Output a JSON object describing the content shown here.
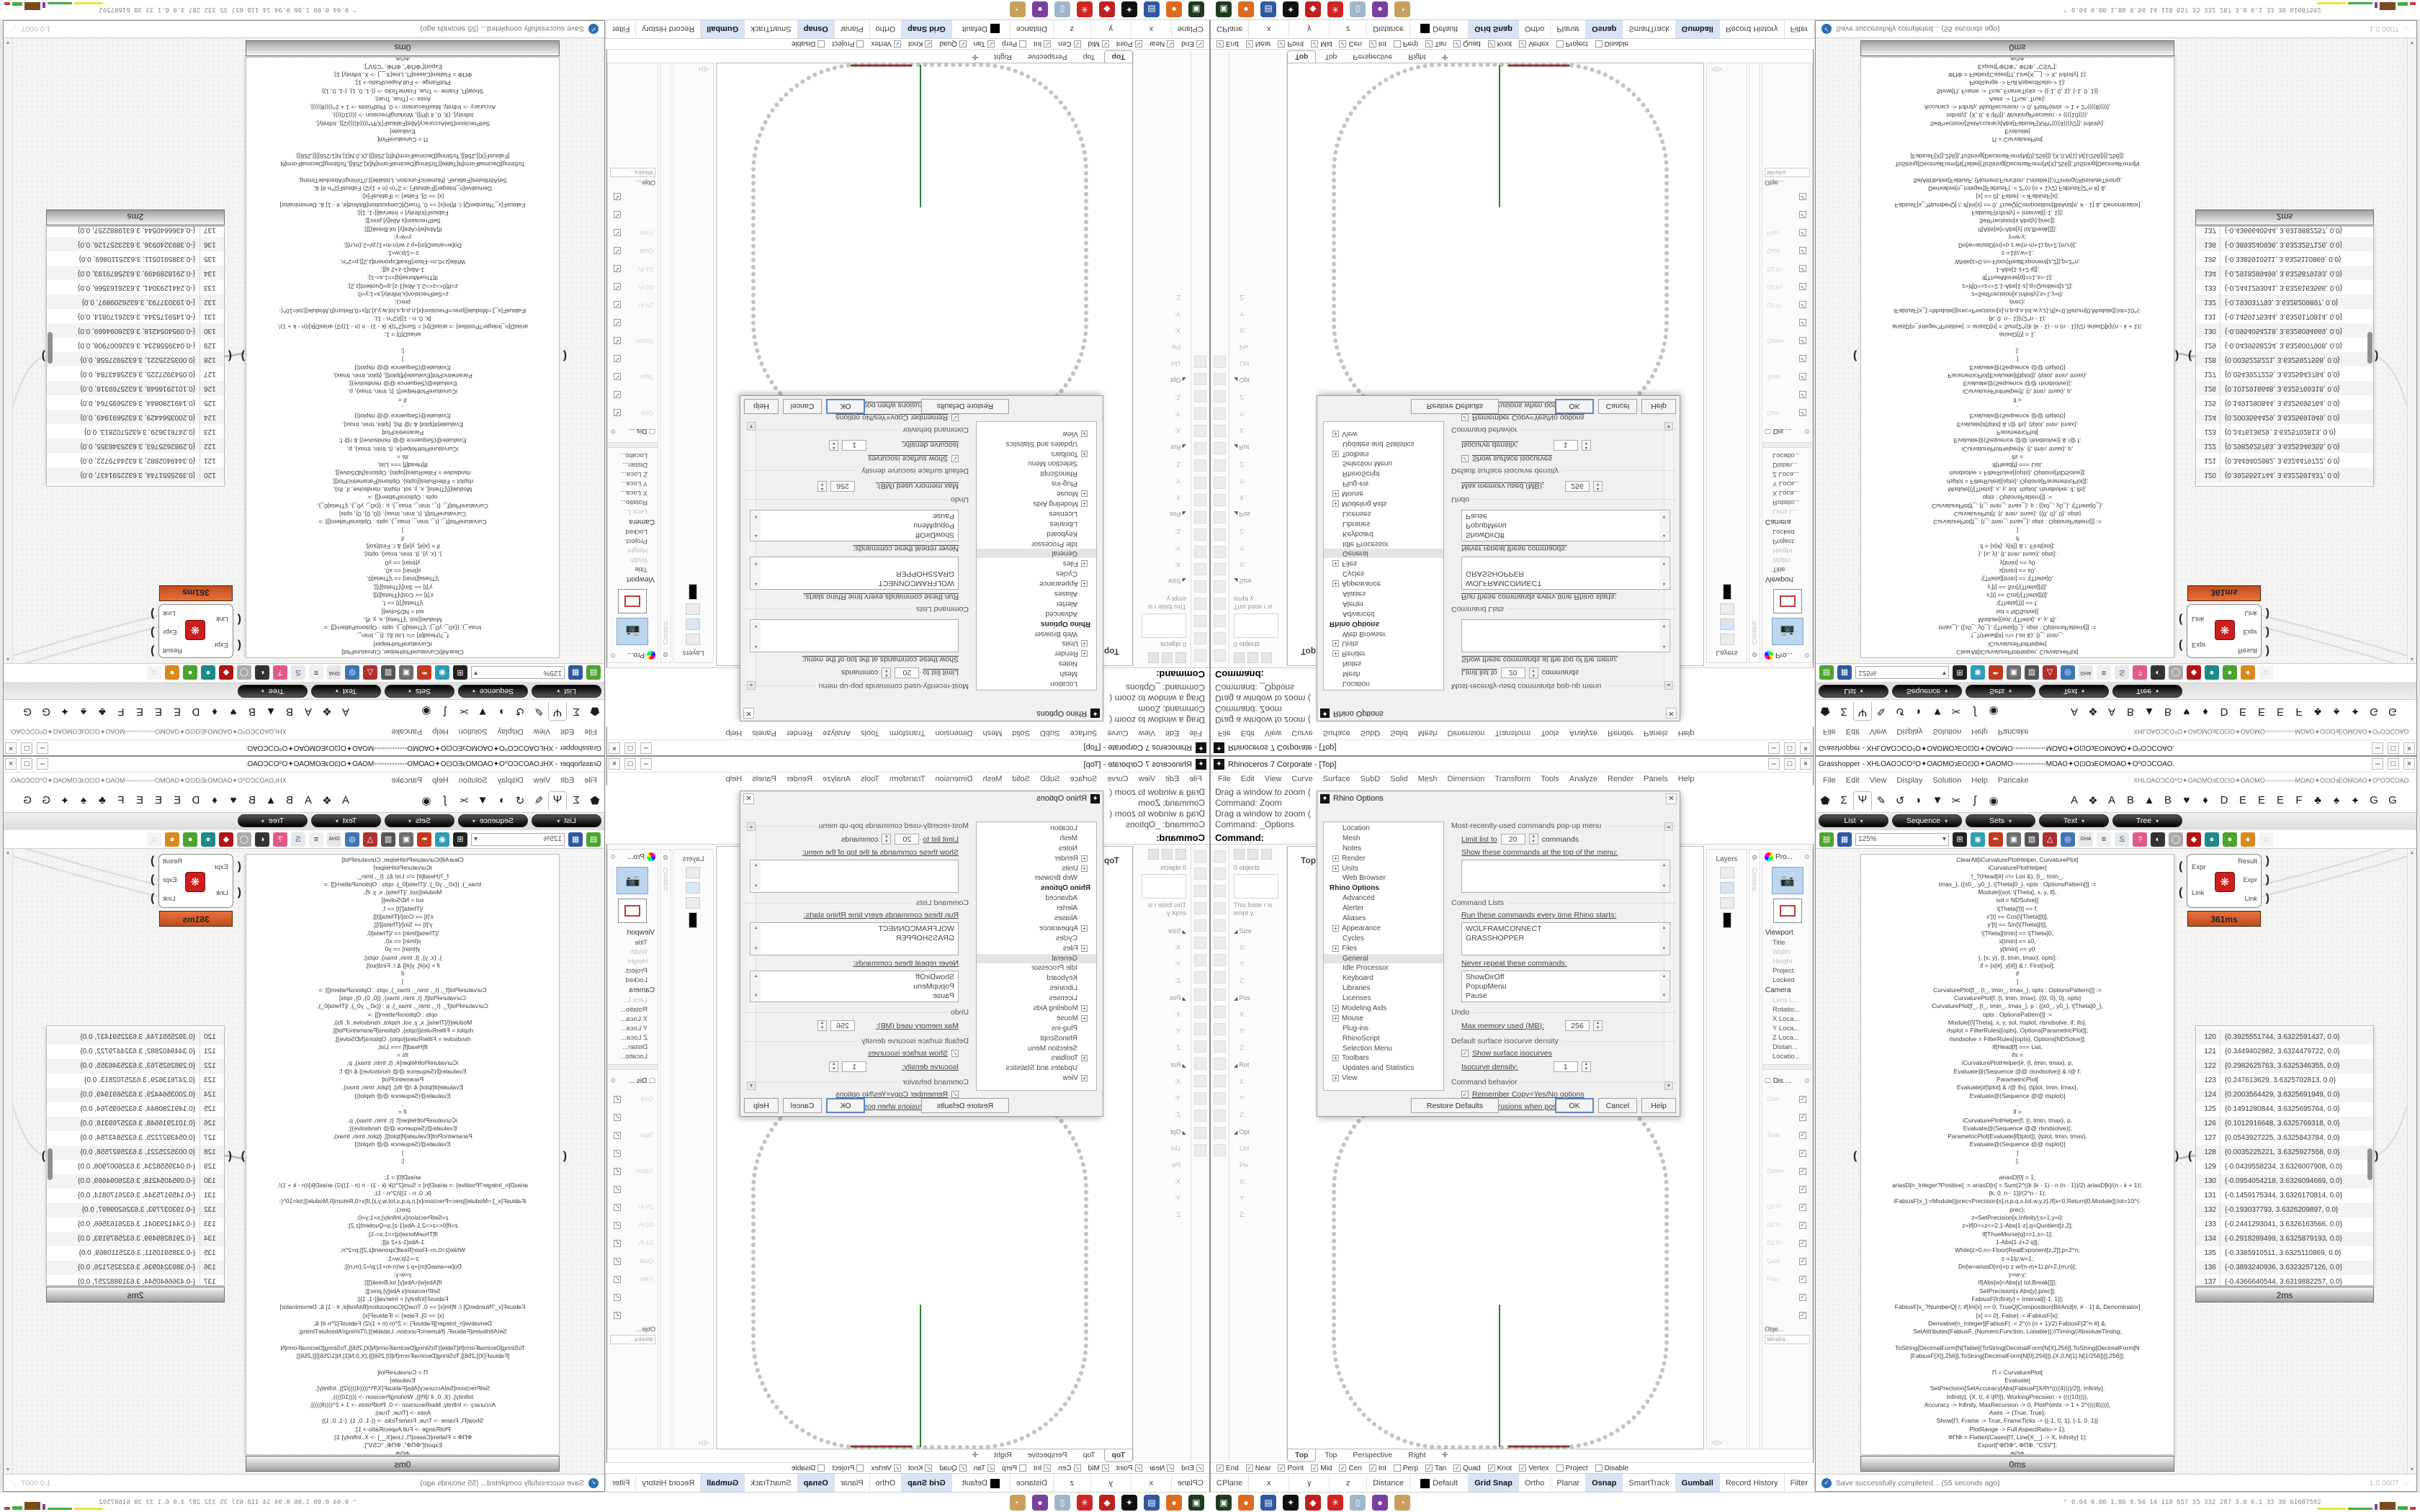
{
  "rhino": {
    "title": "Rhinoceros 7 Corporate - [Top]",
    "window_buttons": [
      "–",
      "□",
      "×"
    ],
    "menus": [
      "File",
      "Edit",
      "View",
      "Curve",
      "Surface",
      "SubD",
      "Solid",
      "Mesh",
      "Dimension",
      "Transform",
      "Tools",
      "Analyze",
      "Render",
      "Panels",
      "Help"
    ],
    "command_lines": [
      "Drag a window to zoom (",
      "Command: Zoom",
      "Drag a window to zoom (",
      "Command: _Options"
    ],
    "command_prompt": "Command:",
    "viewport": {
      "active_label": "Top",
      "tabs": [
        "Top",
        "Top",
        "Perspective",
        "Right"
      ],
      "new_tab_icon": "✛",
      "axis_green": "#2f7e2f",
      "axis_red": "#8b3434",
      "curve_color": "#c3c3c3"
    },
    "left_panel": {
      "object_count": "0 objects",
      "empty_note": "This folde r is empt y.",
      "rows": [
        {
          "t": "Size",
          "h": true
        },
        {
          "t": "X:"
        },
        {
          "t": "Y:"
        },
        {
          "t": "Z:"
        },
        {
          "t": "Pos",
          "h": true
        },
        {
          "t": "X:"
        },
        {
          "t": "Y:"
        },
        {
          "t": "Z:"
        },
        {
          "t": "Rot",
          "h": true
        },
        {
          "t": "X:"
        },
        {
          "t": "Y:"
        },
        {
          "t": "Z:"
        },
        {
          "t": "Opt",
          "h": true
        },
        {
          "t": "Uni"
        },
        {
          "t": "Piv"
        },
        {
          "t": "X:"
        },
        {
          "t": "Y:"
        },
        {
          "t": "Z:"
        }
      ]
    },
    "right_panels": {
      "layers_label": "Layers",
      "constraint_label": "Constra...",
      "properties_tab": "Pro...",
      "viewport_header": "Viewport",
      "viewport_rows": [
        {
          "t": "Title"
        },
        {
          "t": "Width",
          "dim": true
        },
        {
          "t": "Height",
          "dim": true
        },
        {
          "t": "Project."
        },
        {
          "t": "Locked"
        }
      ],
      "camera_header": "Camera",
      "camera_rows": [
        {
          "t": "Lens L...",
          "dim": true
        },
        {
          "t": "Rotatio..."
        },
        {
          "t": "X Loca..."
        },
        {
          "t": "Y Loca..."
        },
        {
          "t": "Z Loca..."
        },
        {
          "t": "Distan..."
        },
        {
          "t": "Locatio..."
        }
      ],
      "display_tab": "Dis ...",
      "display_row_labels": [
        "Cont",
        "",
        "Tapa",
        "",
        "Option",
        "",
        "UV Fl",
        "G0 Pr",
        "G1 Pr",
        "Quali",
        "Flatn",
        "",
        ""
      ],
      "object_label": "Obje...",
      "display_mode": "Wirefra..."
    },
    "osnap": [
      {
        "label": "End",
        "checked": true
      },
      {
        "label": "Near",
        "checked": true
      },
      {
        "label": "Point",
        "checked": true
      },
      {
        "label": "Mid",
        "checked": true
      },
      {
        "label": "Cen",
        "checked": true
      },
      {
        "label": "Int",
        "checked": true
      },
      {
        "label": "Perp",
        "checked": false
      },
      {
        "label": "Tan",
        "checked": true
      },
      {
        "label": "Quad",
        "checked": true
      },
      {
        "label": "Knot",
        "checked": true
      },
      {
        "label": "Vertex",
        "checked": true
      },
      {
        "label": "Project",
        "checked": false
      },
      {
        "label": "Disable",
        "checked": false
      }
    ],
    "status_bar": [
      {
        "label": "CPlane",
        "w": 60
      },
      {
        "label": "x",
        "w": 110
      },
      {
        "label": "y",
        "w": 110
      },
      {
        "label": "z",
        "w": 100
      },
      {
        "label": "Distance",
        "w": 90
      },
      {
        "label": "Default",
        "w": 170,
        "swatch": true
      },
      {
        "label": "Grid Snap",
        "active": true
      },
      {
        "label": "Ortho"
      },
      {
        "label": "Planar"
      },
      {
        "label": "Osnap",
        "active": true
      },
      {
        "label": "SmartTrack"
      },
      {
        "label": "Gumball",
        "active": true
      },
      {
        "label": "Record History"
      },
      {
        "label": "Filter"
      }
    ],
    "options_dialog": {
      "title": "Rhino Options",
      "tree": [
        {
          "label": "Location"
        },
        {
          "label": "Mesh"
        },
        {
          "label": "Notes"
        },
        {
          "label": "Render",
          "plus": true
        },
        {
          "label": "Units",
          "plus": true
        },
        {
          "label": "Web Browser"
        },
        {
          "label": "Rhino Options",
          "root": true
        },
        {
          "label": "Advanced"
        },
        {
          "label": "Alerter"
        },
        {
          "label": "Aliases"
        },
        {
          "label": "Appearance",
          "plus": true
        },
        {
          "label": "Cycles"
        },
        {
          "label": "Files",
          "plus": true
        },
        {
          "label": "General",
          "selected": true
        },
        {
          "label": "Idle Processor"
        },
        {
          "label": "Keyboard"
        },
        {
          "label": "Libraries"
        },
        {
          "label": "Licenses"
        },
        {
          "label": "Modeling Aids",
          "plus": true
        },
        {
          "label": "Mouse",
          "plus": true
        },
        {
          "label": "Plug-ins"
        },
        {
          "label": "RhinoScript"
        },
        {
          "label": "Selection Menu"
        },
        {
          "label": "Toolbars",
          "plus": true
        },
        {
          "label": "Updates and Statistics"
        },
        {
          "label": "View",
          "plus": true
        }
      ],
      "mru_header": "Most-recently-used commands pop-up menu",
      "limit_label": "Limit list to",
      "limit_value": "20",
      "limit_suffix": "commands",
      "show_label": "Show these commands at the top of the menu:",
      "cmdlists_header": "Command Lists",
      "run_label": "Run these commands every time Rhino starts:",
      "run_items": [
        "WOLFRAMCONNECT",
        "GRASSHOPPER"
      ],
      "never_label": "Never repeat these commands:",
      "never_items": [
        "ShowDirOff",
        "PopupMenu",
        "Pause"
      ],
      "undo_header": "Undo",
      "memory_label": "Max memory used (MB):",
      "memory_value": "256",
      "iso_header": "Default surface isocurve density",
      "iso_check": "Show surface isocurves",
      "density_label": "Isocurve density:",
      "density_value": "1",
      "behavior_header": "Command behavior",
      "behavior_checks": [
        "Remember Copy=Yes/No options",
        "Use extrusions when possible"
      ],
      "buttons": [
        "Restore Defaults",
        "OK",
        "Cancel",
        "Help"
      ]
    }
  },
  "gh": {
    "title": "Grasshopper - XHĿΟΑΟϽCΟ⁰Ο✦ΟΑΟΜΟ϶ΕΟ⊡Ο✦ΟΑΟΜΟ◦◦◦◦◦◦◦◦◦◦◦◦◦ΜΟΑΟ✦Ο⊡Ο϶ΕΟΜΟΑΟ✦Ο⁰ΟϽCΟΑΟ.",
    "menus": [
      "File",
      "Edit",
      "View",
      "Display",
      "Solution",
      "Help",
      "Pancake"
    ],
    "doc_glyphs": "XHĿΟΑΟϽCΟ⁰Ο✦ΟΑΟΜΟ϶ΕΟ⊡Ο✦ΟΑΟΜΟ◦◦◦◦◦◦◦◦◦◦◦◦◦ΜΟΑΟ✦Ο⊡Ο϶ΕΟΜΟΑΟ✦Ο⁰ΟϽCΟΑΟ.",
    "param_icons": [
      {
        "name": "params-geometry-icon",
        "glyph": "⬟"
      },
      {
        "name": "params-maths-icon",
        "glyph": "Σ"
      },
      {
        "name": "params-primitive-icon",
        "glyph": "Ψ",
        "active": true
      },
      {
        "name": "params-input-icon",
        "glyph": "✎"
      },
      {
        "name": "curve-icon",
        "glyph": "↺"
      },
      {
        "name": "surface-icon",
        "glyph": "◗"
      },
      {
        "name": "mesh-icon",
        "glyph": "▼"
      },
      {
        "name": "intersect-icon",
        "glyph": "✂"
      },
      {
        "name": "transform-icon",
        "glyph": "ʃ"
      },
      {
        "name": "display-icon",
        "glyph": "◉"
      }
    ],
    "plugin_icons": [
      {
        "name": "tab-a1",
        "glyph": "A"
      },
      {
        "name": "tab-skull",
        "glyph": "❖"
      },
      {
        "name": "tab-a2",
        "glyph": "A"
      },
      {
        "name": "tab-b1",
        "glyph": "B"
      },
      {
        "name": "tab-mountain",
        "glyph": "▲"
      },
      {
        "name": "tab-b2",
        "glyph": "B"
      },
      {
        "name": "tab-shield",
        "glyph": "♥"
      },
      {
        "name": "tab-bird",
        "glyph": "♦"
      },
      {
        "name": "tab-d",
        "glyph": "D"
      },
      {
        "name": "tab-e1",
        "glyph": "E"
      },
      {
        "name": "tab-e2",
        "glyph": "E"
      },
      {
        "name": "tab-e3",
        "glyph": "E"
      },
      {
        "name": "tab-f",
        "glyph": "F"
      },
      {
        "name": "tab-fly",
        "glyph": "♣"
      },
      {
        "name": "tab-paw",
        "glyph": "♠"
      },
      {
        "name": "tab-feather",
        "glyph": "✦"
      },
      {
        "name": "tab-g1",
        "glyph": "G"
      },
      {
        "name": "tab-g2",
        "glyph": "G"
      }
    ],
    "pills": [
      "List",
      "Sequence",
      "Sets",
      "Text",
      "Tree"
    ],
    "zoom_value": "125%",
    "toolbar_icons": [
      {
        "name": "new-document-icon",
        "glyph": "▤",
        "bg": "#4da32f"
      },
      {
        "name": "save-document-icon",
        "glyph": "▦",
        "bg": "#2f58a3"
      },
      {
        "name": "zoom-extents-icon",
        "glyph": "⊞",
        "bg": "#222"
      },
      {
        "name": "preview-eye-icon",
        "glyph": "◉",
        "bg": "#2d9db5"
      },
      {
        "name": "draw-pen-icon",
        "glyph": "✒",
        "bg": "#c23a1f"
      },
      {
        "name": "bake-icon",
        "glyph": "▣",
        "bg": "#6d6d6d"
      },
      {
        "name": "speaker-icon",
        "glyph": "▥",
        "bg": "#555"
      },
      {
        "name": "tripod-icon",
        "glyph": "△",
        "bg": "#b03030"
      },
      {
        "name": "core-icon",
        "glyph": "◎",
        "bg": "#3f74b5"
      },
      {
        "name": "gha-icon",
        "glyph": "GHA",
        "bg": "#e8e8e8",
        "fg": "#333"
      },
      {
        "name": "script-doc-icon",
        "glyph": "≡",
        "bg": "#f0f0f0",
        "fg": "#333"
      },
      {
        "name": "search-s-icon",
        "glyph": "S",
        "bg": "#e8e8e8",
        "fg": "#2d6db5"
      },
      {
        "name": "cluster-icon",
        "glyph": "?",
        "bg": "#e05a8a"
      },
      {
        "name": "mesh-spheres-icon",
        "glyph": "◐",
        "bg": "#333"
      },
      {
        "name": "wireframe-icon",
        "glyph": "◯",
        "bg": "#aaa"
      },
      {
        "name": "gem-icon",
        "glyph": "◆",
        "bg": "#b01515"
      },
      {
        "name": "ball-teal-icon",
        "glyph": "●",
        "bg": "#1d8a8a"
      },
      {
        "name": "ball-green-icon",
        "glyph": "●",
        "bg": "#4da32f"
      },
      {
        "name": "ball-orange-icon",
        "glyph": "●",
        "bg": "#d98a1f"
      },
      {
        "name": "selection-dashed-icon",
        "glyph": "◌",
        "bg": "#f4f4f4",
        "fg": "#777"
      }
    ],
    "expr": {
      "inputs": [
        "Expr",
        "Link"
      ],
      "outputs": [
        "Result",
        "Expr",
        "Link"
      ],
      "time": "361ms",
      "icon": "❋"
    },
    "code_time": "0ms",
    "list_time": "2ms",
    "status_left": "Save successfully completed... (55 seconds ago)",
    "status_right": "1.0.0007",
    "code_lines": [
      "ClearAll[iCurvaturePlotHelper, CurvaturePlot]",
      "iCurvaturePlotHelper[",
      "f_?(Head[#] =!= List &), {t_, tmin_,",
      "tmax_}, {{x0_, y0_}, \\[Theta]0_}, opts : OptionsPattern[]] :=",
      "Module[{sol, \\[Theta], x, y, if},",
      "sol = NDSolve[{",
      "\\[Theta]'[t] == f,",
      "x'[t] == Cos[\\[Theta][t]],",
      "y'[t] == Sin[\\[Theta][t]],",
      "\\[Theta][tmin] == \\[Theta]0,",
      "x[tmin] == x0,",
      "y[tmin] == y0",
      "}, {x, y}, {t, tmin, tmax}, opts];",
      "if = {x[#], y[#]} & /. First[sol];",
      "if",
      "]",
      "CurvaturePlot[f_, {t_, tmin_, tmax_}, opts : OptionsPattern[]] :=",
      "CurvaturePlot[f, {t, tmin, tmax}, {{0, 0}, 0}, opts]",
      "CurvaturePlot[f_, {t_, tmin_, tmax_}, p : {{x0_, y0_}, \\[Theta]0_},",
      "opts : OptionsPattern[]] :=",
      "Module[{\\[Theta], x, y, sol, rlsplot, rlsndsolve, if, ifs},",
      "rlsplot = FilterRules[{opts}, Options[ParametricPlot]];",
      "rlsndsolve = FilterRules[{opts}, Options[NDSolve]];",
      "If[Head[f] === List,",
      "ifs =",
      "iCurvaturePlotHelper[#, {t, tmin, tmax}, p,",
      "Evaluate@(Sequence @@ rlsndsolve)] & /@ f;",
      "ParametricPlot[",
      "Evaluate[#[tplot] & /@ ifs], {tplot, tmin, tmax},",
      "Evaluate@(Sequence @@ rlsplot)]",
      ",",
      "if =",
      "iCurvaturePlotHelper[f, {t, tmin, tmax}, p,",
      "Evaluate@(Sequence @@ rlsndsolve)];",
      "ParametricPlot[Evaluate[if[tplot]], {tplot, tmin, tmax},",
      "Evaluate@(Sequence @@ rlsplot)]",
      "]",
      "];",
      "",
      "ariasD[0] = 1;",
      "ariasD[n_Integer?Positive] := ariasD[n] = Sum[2^((k (k - 1) - n (n - 1))/2) ariasD[k]/(n - k + 1)!,",
      "{k, 0, n - 1}]/(2^n - 1);",
      "iFabiusF[x_]:=Module[{prec=Precision[x],n,p,q,s,tol,w,y,z},If[x<0,Return[0,Module]];tol=10^(-",
      "prec);",
      "z=SetPrecision[x,Infinity];s=1;y=0;",
      "z=If[0<=z<=2,1-Abs[1-z],q=Quotient[z,2];",
      "If[ThueMorse[q]==1,s=-1];",
      "1-Abs[1-z+2 q]];",
      "While[z>0,n=-Floor[RealExponent[z,2]];p=2^n;",
      "z-=1/p;w=1;",
      "Do[w=ariasD[m]+p z w/(n-m+1);p/=2,{m,n}];",
      "y=w-y;",
      "If[Abs[w]<Abs[y] tol,Break[]]];",
      "SetPrecision[s Abs[y],prec]];",
      "FabiusF[Infinity] = Interval[{-1, 1}];",
      "FabiusF[x_?NumberQ] /; If[Im[x] == 0, TrueQ[Composition[BitAnd[#, # - 1] &, Denominator]",
      "[x] == 0], False] := iFabiusF[x];",
      "Derivative[n_Integer][FabiusF] := 2^(n (n + 1)/2) FabiusF[2^n #] &;",
      "SetAttributes[FabiusF, {NumericFunction, Listable}];//Timing//AbsoluteTiming;",
      "",
      "ToString[DecimalForm[N[Table[{ToString[DecimalForm[N[X],256]],ToString[DecimalForm[N",
      "[FabiusF[X]],256]],ToString[DecimalForm[N[0],256]]},{X,0,N[1],N[1/256]}]],256]];",
      "",
      "Π = CurvaturePlot[",
      "Evaluate[",
      "SetPrecision[SetAccuracy[Abs[FabiusF[X/Pi*((((4))))/2]], Infinity],",
      "Infinity], {X, 0, 4 \\[Pi]}, WorkingPrecision -> ((((10)))),",
      "Accuracy -> Infinity, MaxRecursion -> 0, PlotPoints -> 1 + 2^((((8))))],",
      "Axes -> {True, True};",
      "Show[Π, Frame -> True, FrameTicks -> {{-1, 0, 1}, {-1, 0, 1}}",
      "PlotRange -> Full AspectRatio-> 1];",
      "ΦΠΦ = Flatten[Cases[Π, Line[X__] -> X, Infinity] 1];",
      "Export[\"ΦΠΦ\", ΦΠΦ, \"CSV\"];",
      "ΦΠΦ"
    ],
    "list_rows": [
      {
        "n": "120",
        "v": "{0.3925551744, 3.6322591437, 0.0}"
      },
      {
        "n": "121",
        "v": "{0.3449402882, 3.6324479722, 0.0}"
      },
      {
        "n": "122",
        "v": "{0.2982625763, 3.6325346355, 0.0}"
      },
      {
        "n": "123",
        "v": "{0.247613629, 3.6325702813, 0.0}"
      },
      {
        "n": "124",
        "v": "{0.2003564429, 3.6325691949, 0.0}"
      },
      {
        "n": "125",
        "v": "{0.1491280844, 3.6325695764, 0.0}"
      },
      {
        "n": "126",
        "v": "{0.1012916648, 3.6325769318, 0.0}"
      },
      {
        "n": "127",
        "v": "{0.0543927225, 3.6325843784, 0.0}"
      },
      {
        "n": "128",
        "v": "{0.0035225221, 3.6325927558, 0.0}"
      },
      {
        "n": "129",
        "v": "{-0.0439558234, 3.6326007908, 0.0}"
      },
      {
        "n": "130",
        "v": "{-0.0954054218, 3.6326094669, 0.0}"
      },
      {
        "n": "131",
        "v": "{-0.1459175344, 3.6326170814, 0.0}"
      },
      {
        "n": "132",
        "v": "{-0.193037793, 3.6326209897, 0.0}"
      },
      {
        "n": "133",
        "v": "{-0.2441293041, 3.6326163566, 0.0}"
      },
      {
        "n": "134",
        "v": "{-0.2918289499, 3.6325879193, 0.0}"
      },
      {
        "n": "135",
        "v": "{-0.3385910511, 3.6325110869, 0.0}"
      },
      {
        "n": "136",
        "v": "{-0.3893240936, 3.6323257126, 0.0}"
      },
      {
        "n": "137",
        "v": "{-0.4366640544, 3.6319882257, 0.0}"
      }
    ]
  },
  "taskbar": {
    "icons": [
      {
        "name": "taskbar-obs-icon",
        "glyph": "▣",
        "bg": "#1e3b1e"
      },
      {
        "name": "taskbar-firefox-icon",
        "glyph": "●",
        "bg": "#e06a1f"
      },
      {
        "name": "taskbar-save-icon",
        "glyph": "▤",
        "bg": "#2f58a3"
      },
      {
        "name": "taskbar-rhino-icon",
        "glyph": "✦",
        "bg": "#111"
      },
      {
        "name": "taskbar-keepass-icon",
        "glyph": "◆",
        "bg": "#c02020"
      },
      {
        "name": "taskbar-gear-icon",
        "glyph": "✳",
        "bg": "#d02525"
      },
      {
        "name": "taskbar-notes-icon",
        "glyph": "▯",
        "bg": "#9fb6cc"
      },
      {
        "name": "taskbar-chat-icon",
        "glyph": "●",
        "bg": "#7a3fa0"
      },
      {
        "name": "taskbar-palette-icon",
        "glyph": "◔",
        "bg": "#c9a05a"
      }
    ],
    "perf": "⌃  0.04 0.00 1.86 0.94   14   118  657   35   332  287   3.0   6.1   33   30  61607592"
  }
}
